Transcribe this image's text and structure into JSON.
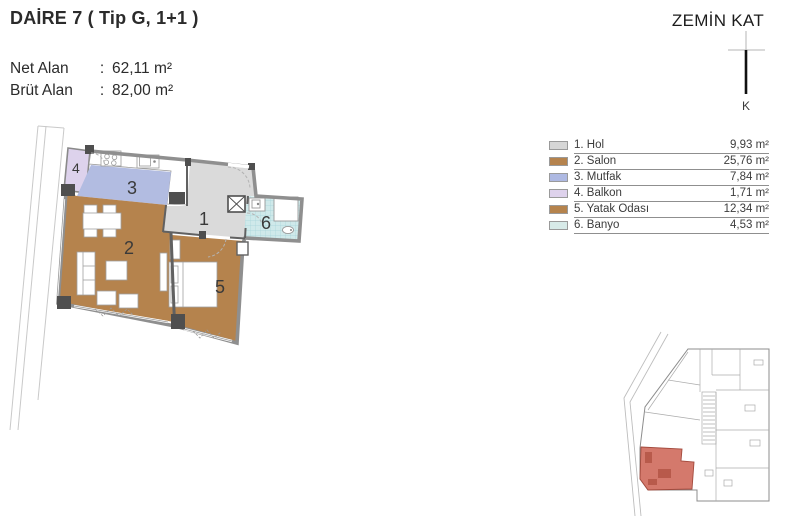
{
  "header": {
    "title": "DAİRE 7 ( Tip G, 1+1 )",
    "rows": [
      {
        "label": "Net Alan",
        "sep": ":",
        "value": "62,11 m²"
      },
      {
        "label": "Brüt Alan",
        "sep": ":",
        "value": "82,00 m²"
      }
    ]
  },
  "floor_title": "ZEMİN KAT",
  "north": {
    "label": "K"
  },
  "legend": [
    {
      "label": "1. Hol",
      "area": "9,93 m²",
      "color": "#d6d6d6"
    },
    {
      "label": "2. Salon",
      "area": "25,76 m²",
      "color": "#b5834d"
    },
    {
      "label": "3. Mutfak",
      "area": "7,84 m²",
      "color": "#aeb9e2"
    },
    {
      "label": "4. Balkon",
      "area": "1,71 m²",
      "color": "#ded2ec"
    },
    {
      "label": "5. Yatak Odası",
      "area": "12,34 m²",
      "color": "#b5834d"
    },
    {
      "label": "6. Banyo",
      "area": "4,53 m²",
      "color": "#d7eae8"
    }
  ],
  "plan": {
    "rooms": {
      "hol": {
        "num": "1",
        "color": "#dadada"
      },
      "salon": {
        "num": "2",
        "color": "#b5834d"
      },
      "mutfak": {
        "num": "3",
        "color": "#b2bce1"
      },
      "balkon": {
        "num": "4",
        "color": "#ddd2ec"
      },
      "yatak": {
        "num": "5",
        "color": "#b5834d"
      },
      "banyo": {
        "num": "6",
        "color": "#cfe9ea"
      }
    },
    "highlight_color": "#d4796c"
  }
}
